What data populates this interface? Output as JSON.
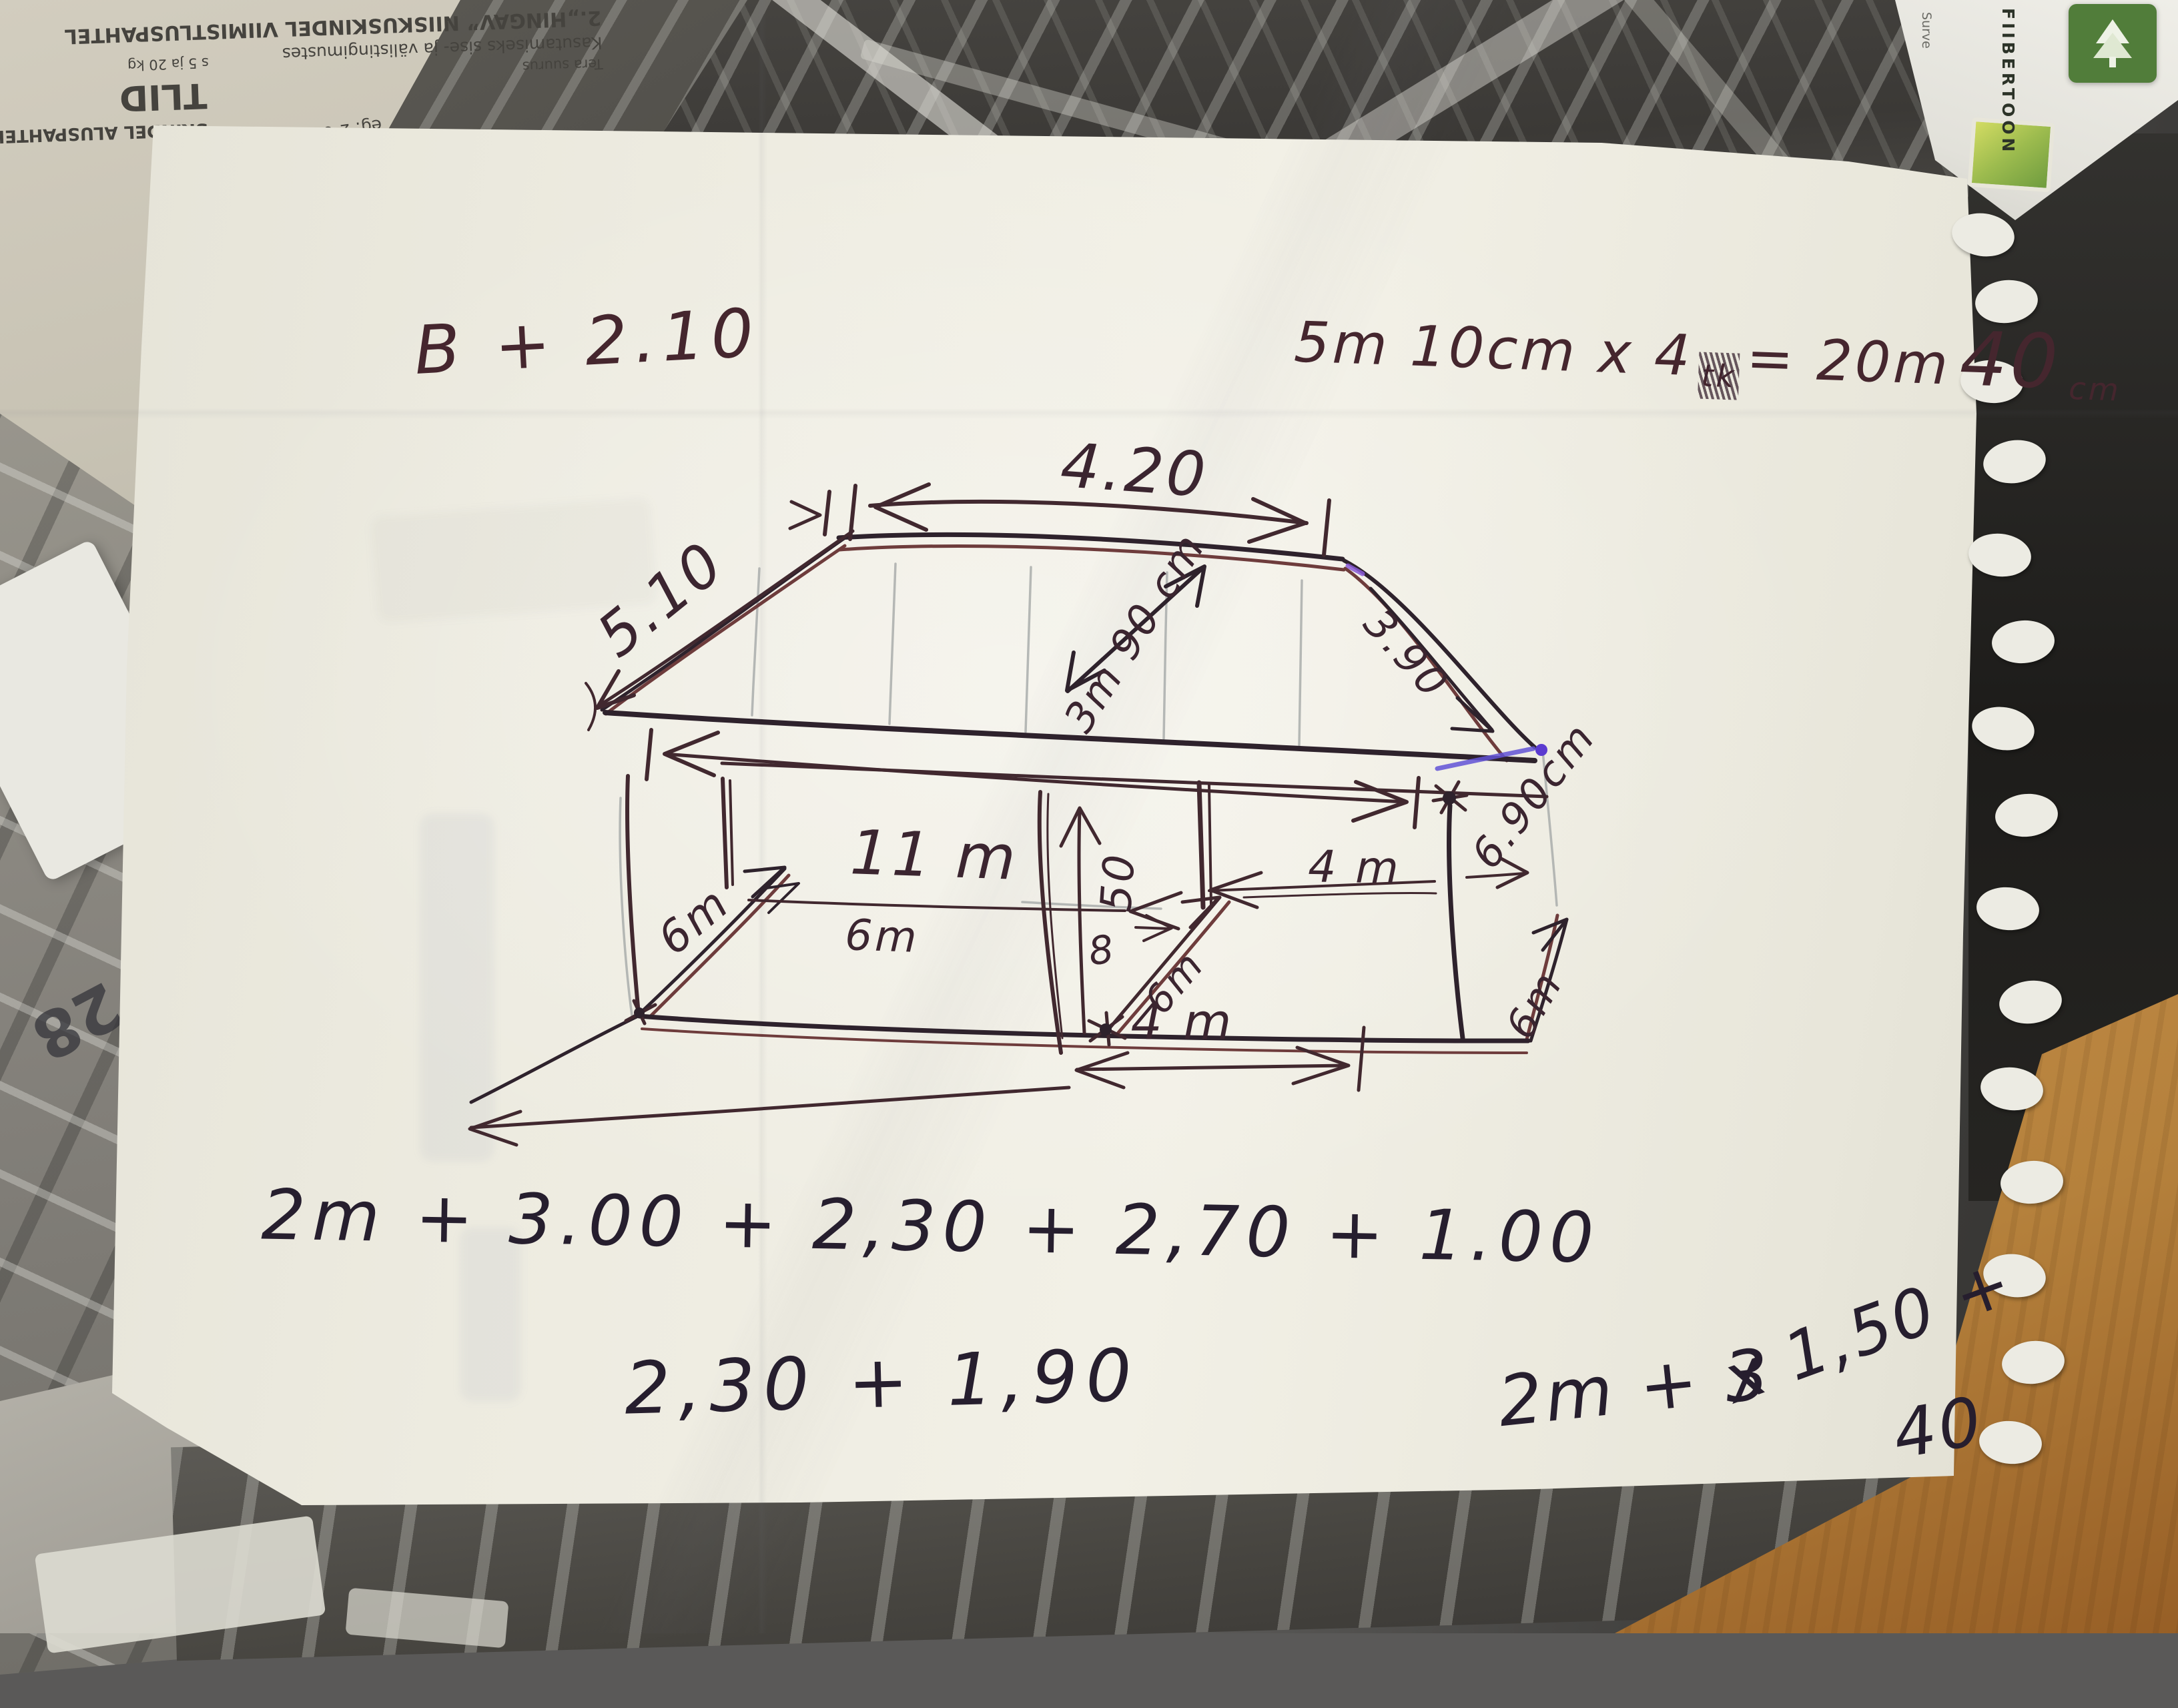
{
  "photo": {
    "handwritten": {
      "top_left_note": "B + 2.10",
      "top_right_note": {
        "lhs": "5m 10cm x 4",
        "scratched": "tk",
        "rhs_eq": "= 20m",
        "rhs_big": "40",
        "rhs_unit": "cm"
      },
      "dims": {
        "ridge_top": "4.20",
        "left_slope": "5.10",
        "roof_diagonal": "3m 90 cm",
        "right_slope": "3.90",
        "right_depth": "6.90cm",
        "front_length": "11 m",
        "left_diag": "6m",
        "mid_span": "6m",
        "center_height": "50",
        "center_mark": "8",
        "center_diag": "6m",
        "right_span": "4 m",
        "bottom_span": "4 m",
        "bottom_right_diag": "6m"
      },
      "equations": {
        "line1": "2m + 3.00 + 2,30 + 2,70 + 1.00",
        "line2": "2,30 + 1,90",
        "line3_a": "2m + 3",
        "line3_b": "x 1,50 +",
        "line3_c": "40"
      }
    },
    "printed_background": {
      "headline": "2.„HINGAV” NIISKUSKINDEL VIIMISTLUSPAHTEL",
      "subline": "Kasutamiseks sise- ja välistingimustes",
      "subline2": "Tera suurus",
      "fragment_big": "TLID",
      "fragment_bold": "SKINDEL ALUSPAHTEL",
      "fragment_small": "s 5 ja 20 kg",
      "details": [
        "eg: 2-6 h",
        ",5 kg/m²",
        "uuma- ja külmakindel",
        ",6 mm",
        "ja välistingimustes"
      ],
      "circle_number": "50",
      "page_number": "28",
      "brand_vertical": "FIIBERTOON",
      "brand_small": "Surve"
    }
  }
}
